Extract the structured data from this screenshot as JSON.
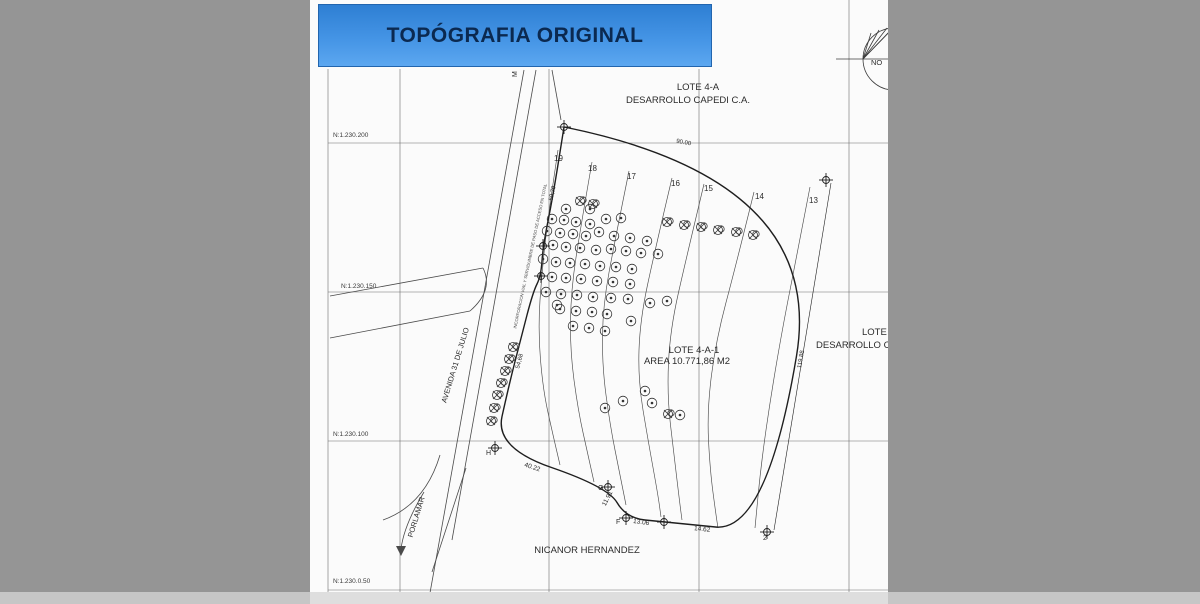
{
  "banner": {
    "title": "TOPÓGRAFIA ORIGINAL",
    "bg": "#4494e5",
    "text_color": "#0b2950"
  },
  "colors": {
    "surround_gray": "#959595",
    "canvas_white": "#fbfbfb",
    "line": "#3c3c3c",
    "boundary": "#1e1e1e",
    "scrollbar": "#c6c6c6"
  },
  "grid_labels": {
    "n200": "N:1.230.200",
    "n150": "N:1.230.150",
    "n100": "N:1.230.100",
    "n050": "N:1.230.0.50"
  },
  "parcel": {
    "name": "LOTE 4-A-1",
    "area": "AREA 10.771,86 M2",
    "north_lot": "LOTE 4-A",
    "north_owner": "DESARROLLO CAPEDI C.A.",
    "east_lot": "LOTE",
    "east_owner": "DESARROLLO CA",
    "south_owner": "NICANOR HERNANDEZ"
  },
  "streets": {
    "avenida": "AVENIDA 31 DE JULIO",
    "porlamar": "PORLAMAR",
    "m_label": "M",
    "easement_note": "INCORPORACION VIAL Y SERVIDUMBRE DE PASO DE ACCESO EN TOTAL"
  },
  "north_symbol": {
    "label": "NO"
  },
  "small_labels": [
    {
      "id": "dim-90-00",
      "t": "90.00",
      "x": 676,
      "y": 140,
      "s": 6,
      "r": 11
    },
    {
      "id": "dim-119-88",
      "t": "119.88",
      "x": 793,
      "y": 356,
      "s": 6,
      "r": -80
    },
    {
      "id": "dim-50-79",
      "t": "50,79",
      "x": 546,
      "y": 190,
      "s": 6,
      "r": -78
    },
    {
      "id": "dim-54-68",
      "t": "54,68",
      "x": 513,
      "y": 358,
      "s": 6,
      "r": -75
    },
    {
      "id": "dim-40-22",
      "t": "40.22",
      "x": 524,
      "y": 464,
      "s": 6.5,
      "r": 18
    },
    {
      "id": "dim-11-91",
      "t": "11.91",
      "x": 600,
      "y": 495,
      "s": 6.5,
      "r": -63
    },
    {
      "id": "dim-13-06",
      "t": "13.06",
      "x": 633,
      "y": 519,
      "s": 6.5,
      "r": 8
    },
    {
      "id": "dim-14-62",
      "t": "14.62",
      "x": 694,
      "y": 526,
      "s": 6.5,
      "r": 6
    },
    {
      "id": "contour-19",
      "t": "19",
      "x": 554,
      "y": 154,
      "s": 8,
      "r": 0
    },
    {
      "id": "contour-18",
      "t": "18",
      "x": 588,
      "y": 164,
      "s": 8,
      "r": 0
    },
    {
      "id": "contour-17",
      "t": "17",
      "x": 627,
      "y": 172,
      "s": 8,
      "r": 0
    },
    {
      "id": "contour-16",
      "t": "16",
      "x": 671,
      "y": 179,
      "s": 8,
      "r": 0
    },
    {
      "id": "contour-15",
      "t": "15",
      "x": 704,
      "y": 184,
      "s": 8,
      "r": 0
    },
    {
      "id": "contour-14",
      "t": "14",
      "x": 755,
      "y": 192,
      "s": 8,
      "r": 0
    },
    {
      "id": "contour-13",
      "t": "13",
      "x": 809,
      "y": 196,
      "s": 8,
      "r": 0
    },
    {
      "id": "vertex-H",
      "t": "H",
      "x": 486,
      "y": 450,
      "s": 7,
      "r": 0
    },
    {
      "id": "vertex-G",
      "t": "G",
      "x": 598,
      "y": 485,
      "s": 7,
      "r": 0
    },
    {
      "id": "vertex-F",
      "t": "F",
      "x": 616,
      "y": 519,
      "s": 7,
      "r": 0
    },
    {
      "id": "vertex-2",
      "t": "2",
      "x": 763,
      "y": 535,
      "s": 7,
      "r": 0
    }
  ],
  "geometry": {
    "grid_v": [
      [
        328,
        69,
        604
      ],
      [
        400,
        69,
        592
      ],
      [
        549,
        69,
        592
      ],
      [
        699,
        69,
        592
      ],
      [
        849,
        0,
        592
      ]
    ],
    "grid_h_y": [
      143,
      292,
      441,
      590
    ],
    "grid_h_x": [
      328,
      888
    ],
    "boundary": [
      [
        564,
        127
      ],
      [
        826,
        180
      ],
      [
        767,
        532
      ],
      [
        664,
        522
      ],
      [
        626,
        518
      ],
      [
        608,
        487
      ],
      [
        495,
        448
      ],
      [
        509,
        385
      ],
      [
        521,
        338
      ],
      [
        533,
        292
      ],
      [
        541,
        276
      ],
      [
        543,
        246
      ],
      [
        553,
        196
      ],
      [
        564,
        127
      ]
    ],
    "dim_line": [
      831,
      183,
      774,
      530
    ],
    "vertex_markers": [
      [
        564,
        127
      ],
      [
        826,
        180
      ],
      [
        767,
        532
      ],
      [
        664,
        522
      ],
      [
        626,
        518
      ],
      [
        608,
        487
      ],
      [
        495,
        448
      ],
      [
        543,
        246
      ],
      [
        541,
        276
      ]
    ],
    "contours": [
      [
        [
          558,
          150
        ],
        [
          549,
          210
        ],
        [
          542,
          270
        ],
        [
          538,
          330
        ],
        [
          543,
          390
        ],
        [
          553,
          435
        ],
        [
          560,
          465
        ]
      ],
      [
        [
          592,
          162
        ],
        [
          581,
          225
        ],
        [
          571,
          290
        ],
        [
          570,
          350
        ],
        [
          578,
          410
        ],
        [
          588,
          455
        ],
        [
          594,
          482
        ]
      ],
      [
        [
          629,
          171
        ],
        [
          615,
          240
        ],
        [
          603,
          305
        ],
        [
          602,
          365
        ],
        [
          610,
          425
        ],
        [
          620,
          475
        ],
        [
          626,
          505
        ]
      ],
      [
        [
          672,
          178
        ],
        [
          655,
          250
        ],
        [
          640,
          320
        ],
        [
          638,
          380
        ],
        [
          648,
          440
        ],
        [
          658,
          495
        ],
        [
          661,
          517
        ]
      ],
      [
        [
          704,
          184
        ],
        [
          687,
          255
        ],
        [
          670,
          330
        ],
        [
          667,
          395
        ],
        [
          674,
          455
        ],
        [
          680,
          505
        ],
        [
          682,
          520
        ]
      ],
      [
        [
          754,
          192
        ],
        [
          736,
          265
        ],
        [
          716,
          340
        ],
        [
          707,
          410
        ],
        [
          710,
          470
        ],
        [
          716,
          515
        ],
        [
          718,
          528
        ]
      ],
      [
        [
          810,
          187
        ],
        [
          798,
          250
        ],
        [
          784,
          320
        ],
        [
          771,
          395
        ],
        [
          761,
          465
        ],
        [
          755,
          528
        ]
      ]
    ],
    "roads": [
      "M524,70 L428,604",
      "M536,70 L452,540",
      "M552,70 L561,120",
      "M483,268 L330,296",
      "M470,311 L330,338",
      "M483,268 Q494,290 470,311",
      "M466,468 L432,572",
      "M440,455 Q425,505 383,520",
      "M424,492 Q404,525 401,549"
    ],
    "road_arrow": "401,556 396,546 406,546",
    "trees": [
      [
        566,
        209
      ],
      [
        590,
        209
      ],
      [
        552,
        219
      ],
      [
        564,
        220
      ],
      [
        576,
        222
      ],
      [
        590,
        224
      ],
      [
        606,
        219
      ],
      [
        621,
        218
      ],
      [
        547,
        231
      ],
      [
        560,
        233
      ],
      [
        573,
        234
      ],
      [
        586,
        236
      ],
      [
        599,
        232
      ],
      [
        614,
        236
      ],
      [
        630,
        238
      ],
      [
        647,
        241
      ],
      [
        553,
        245
      ],
      [
        566,
        247
      ],
      [
        580,
        248
      ],
      [
        596,
        250
      ],
      [
        611,
        249
      ],
      [
        626,
        251
      ],
      [
        641,
        253
      ],
      [
        658,
        254
      ],
      [
        543,
        259
      ],
      [
        556,
        262
      ],
      [
        570,
        263
      ],
      [
        585,
        264
      ],
      [
        600,
        266
      ],
      [
        616,
        267
      ],
      [
        632,
        269
      ],
      [
        552,
        277
      ],
      [
        566,
        278
      ],
      [
        581,
        279
      ],
      [
        597,
        281
      ],
      [
        613,
        282
      ],
      [
        630,
        284
      ],
      [
        546,
        292
      ],
      [
        561,
        294
      ],
      [
        577,
        295
      ],
      [
        593,
        297
      ],
      [
        611,
        298
      ],
      [
        628,
        299
      ],
      [
        560,
        309
      ],
      [
        576,
        311
      ],
      [
        592,
        312
      ],
      [
        607,
        314
      ],
      [
        557,
        305
      ],
      [
        573,
        326
      ],
      [
        589,
        328
      ],
      [
        605,
        331
      ],
      [
        631,
        321
      ],
      [
        650,
        303
      ],
      [
        667,
        301
      ],
      [
        605,
        408
      ],
      [
        623,
        401
      ],
      [
        645,
        391
      ],
      [
        652,
        403
      ],
      [
        680,
        415
      ]
    ],
    "marked_trees": [
      [
        580,
        201
      ],
      [
        593,
        204
      ],
      [
        667,
        222
      ],
      [
        684,
        225
      ],
      [
        701,
        227
      ],
      [
        718,
        230
      ],
      [
        736,
        232
      ],
      [
        753,
        235
      ],
      [
        513,
        347
      ],
      [
        509,
        359
      ],
      [
        505,
        371
      ],
      [
        501,
        383
      ],
      [
        497,
        395
      ],
      [
        494,
        408
      ],
      [
        491,
        421
      ],
      [
        668,
        414
      ]
    ],
    "north": {
      "cx": 894,
      "cy": 59,
      "r": 31,
      "axis": "M836,59 L952,59",
      "wedge": [
        "M863,59 L871,33",
        "M863,59 L879,30",
        "M863,59 L887,28",
        "M863,59 L894,27",
        "M863,59 L894,27 L894,59"
      ]
    }
  }
}
